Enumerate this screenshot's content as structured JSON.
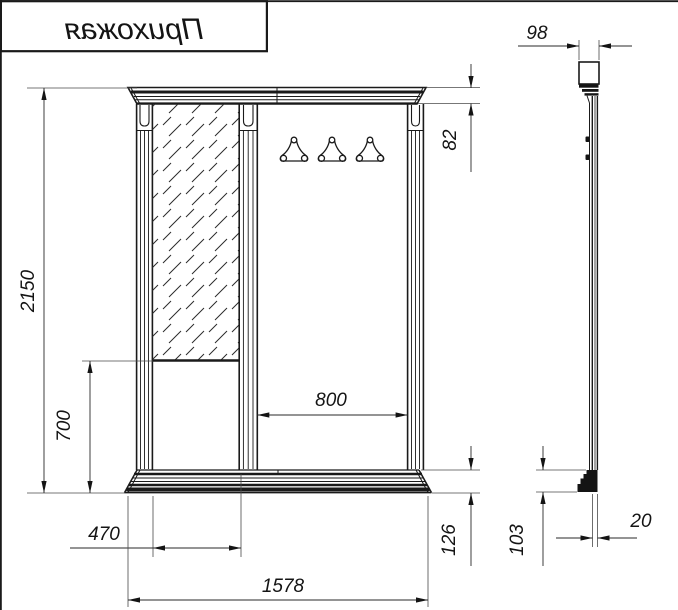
{
  "title_block": {
    "label": "Прихожая",
    "rendered_mirrored": true
  },
  "colors": {
    "line": "#1a1a1a",
    "paper": "#ffffff"
  },
  "front_view": {
    "coat_hook_count": 3,
    "dims": {
      "overall_height": "2150",
      "lower_panel_height": "700",
      "mirror_section_width": "470",
      "overall_width": "1578",
      "open_section_width": "800",
      "cornice_height": "82",
      "plinth_height": "126"
    }
  },
  "side_view": {
    "dims": {
      "top_depth": "98",
      "plinth_height": "103",
      "panel_thickness": "20"
    }
  }
}
